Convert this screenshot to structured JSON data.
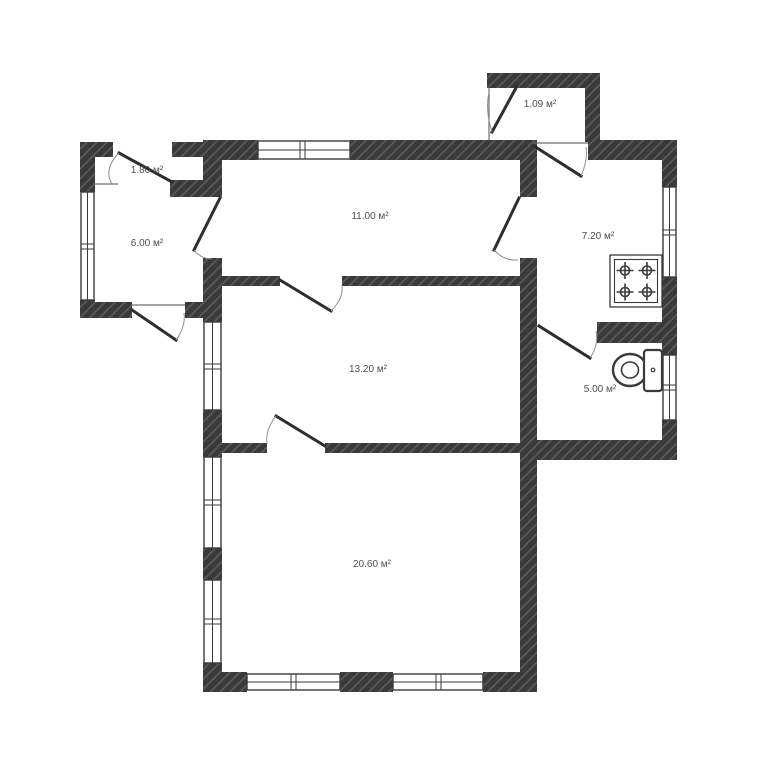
{
  "plan": {
    "rooms": [
      {
        "id": "porch",
        "area_label": "1.09 м²"
      },
      {
        "id": "hall",
        "area_label": "1.80 м²"
      },
      {
        "id": "veranda",
        "area_label": "6.00 м²"
      },
      {
        "id": "room-top",
        "area_label": "11.00 м²"
      },
      {
        "id": "kitchen",
        "area_label": "7.20 м²"
      },
      {
        "id": "room-middle",
        "area_label": "13.20 м²"
      },
      {
        "id": "bathroom",
        "area_label": "5.00 м²"
      },
      {
        "id": "room-bottom",
        "area_label": "20.60 м²"
      }
    ],
    "icons": [
      {
        "name": "stove-icon"
      },
      {
        "name": "toilet-icon"
      }
    ],
    "colors": {
      "wall": "#3a3a3a",
      "wall_hatch": "#5d5d5d",
      "door_leaf": "#2e2e2e",
      "label_text": "#4f4f4f",
      "background": "#ffffff"
    }
  }
}
